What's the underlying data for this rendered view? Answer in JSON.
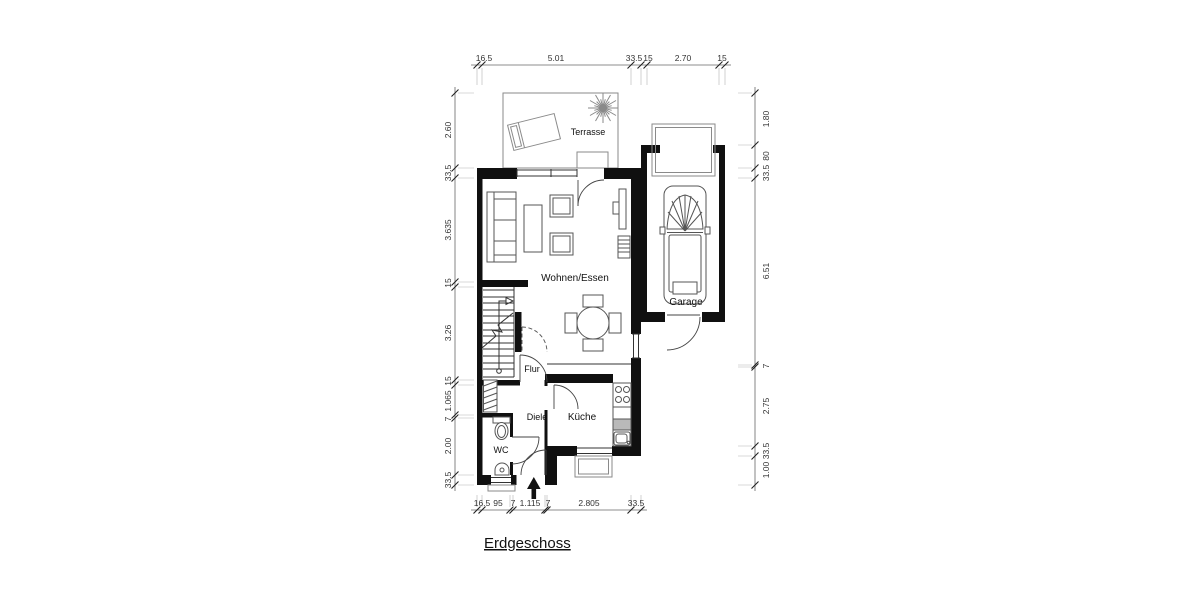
{
  "title": "Erdgeschoss",
  "rooms": {
    "terrasse": "Terrasse",
    "wohnen_essen": "Wohnen/Essen",
    "garage": "Garage",
    "flur": "Flur",
    "diele": "Diele",
    "kueche": "Küche",
    "wc": "WC"
  },
  "dimensions": {
    "top": [
      "16.5",
      "5.01",
      "33.5",
      "15",
      "2.70",
      "15"
    ],
    "bottom": [
      "16.5",
      "95",
      "7",
      "1.115",
      "7",
      "2.805",
      "33.5"
    ],
    "left": [
      "2.60",
      "33.5",
      "3.635",
      "15",
      "3.26",
      "15",
      "1.065",
      "7",
      "2.00",
      "33.5"
    ],
    "right": [
      "1.80",
      "80",
      "33.5",
      "6.51",
      "7",
      "2.75",
      "33.5",
      "1.00"
    ]
  }
}
